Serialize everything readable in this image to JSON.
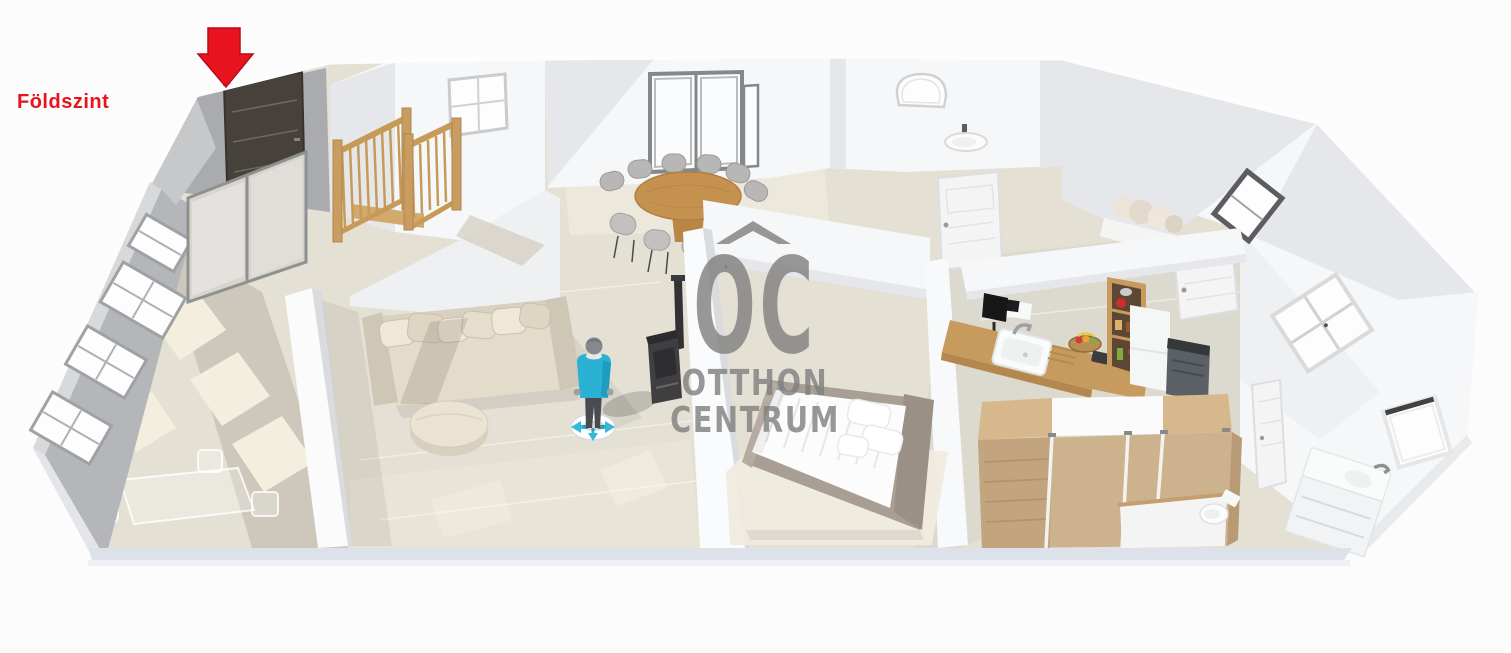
{
  "scene_label": {
    "text": "Földszint",
    "color": "#e8131f"
  },
  "entrance_marker": {
    "shape": "arrow-down",
    "color": "#e8131f"
  },
  "watermark": {
    "monogram": "OC",
    "line1": "OTTHON",
    "line2": "CENTRUM",
    "color": "#8a8a8a"
  },
  "palette": {
    "background": "#fcfcfd",
    "floor": "#e4e0d4",
    "floor_shadow": "#cdc8bb",
    "sunlight_patch": "#f4eede",
    "wall_white": "#f6f7f8",
    "wall_shadow": "#e5e7ea",
    "wall_gray": "#b4b6b9",
    "wood": "#c99b60",
    "wardrobe_wood": "#cdb28e",
    "sofa_beige": "#e4dccb",
    "avatar_shirt": "#2ab1d4",
    "stove_black": "#3f3f41",
    "front_door": "#47413c"
  },
  "scene_objects": [
    "entrance-door",
    "sunroom-windows",
    "sliding-glass-door",
    "staircase",
    "living-sofa",
    "ottoman",
    "dining-table",
    "dining-chairs",
    "tall-glass-doors",
    "person-avatar",
    "wood-stove",
    "double-bed",
    "kitchen-counter",
    "kitchen-sink",
    "kitchen-shelf",
    "fridge",
    "wardrobe",
    "toilet",
    "bathroom-vanity",
    "bathroom-window",
    "arched-window",
    "wall-sink",
    "interior-doors"
  ]
}
